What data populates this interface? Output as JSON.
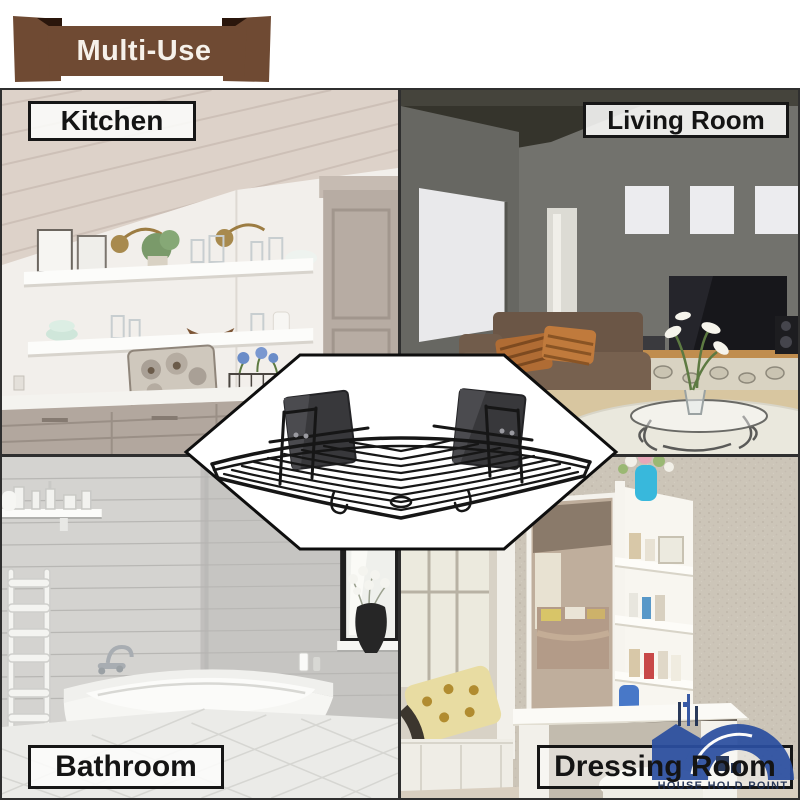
{
  "banner": {
    "label": "Multi-Use"
  },
  "rooms": {
    "kitchen": {
      "label": "Kitchen"
    },
    "living_room": {
      "label": "Living Room"
    },
    "bathroom": {
      "label": "Bathroom"
    },
    "dressing_room": {
      "label": "Dressing Room"
    }
  },
  "logo": {
    "text": "HOUSE HOLD POINT"
  },
  "colors": {
    "banner_brown": "#6f4a33",
    "banner_fold": "#2a160c",
    "label_border": "#161616",
    "logo_blue": "#2b4fa0",
    "logo_navy": "#1b2c50",
    "wire_black": "#161616"
  }
}
